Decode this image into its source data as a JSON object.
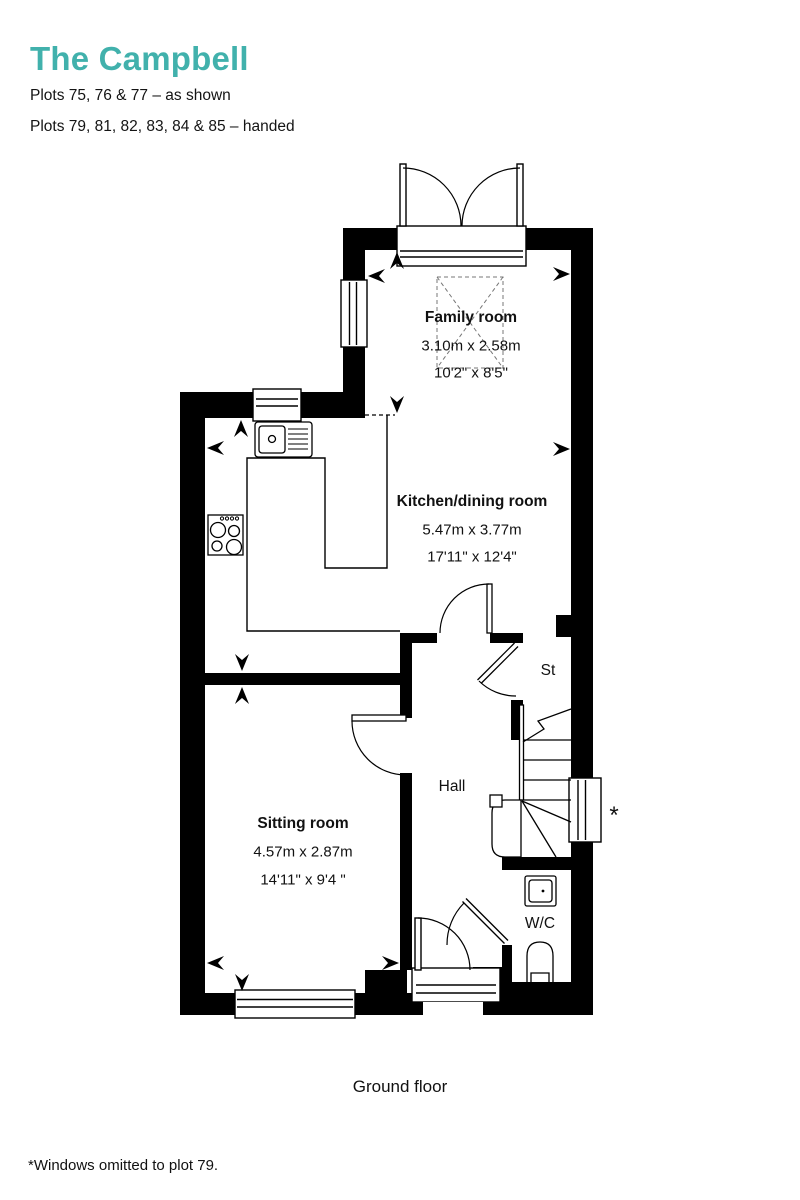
{
  "header": {
    "title": "The Campbell",
    "plots_line1": "Plots 75, 76 & 77 – as shown",
    "plots_line2": "Plots 79, 81, 82, 83, 84 & 85 – handed"
  },
  "colors": {
    "accent_teal": "#41b1ac",
    "wall_black": "#000000"
  },
  "rooms": [
    {
      "id": "family-room",
      "name": "Family room",
      "metric": "3.10m x 2.58m",
      "imperial": "10'2\" x 8'5\""
    },
    {
      "id": "kitchen",
      "name": "Kitchen/dining room",
      "metric": "5.47m x 3.77m",
      "imperial": "17'11\" x 12'4\""
    },
    {
      "id": "sitting-room",
      "name": "Sitting room",
      "metric": "4.57m x 2.87m",
      "imperial": "14'11\" x 9'4 \""
    }
  ],
  "labels": {
    "hall": "Hall",
    "store": "St",
    "wc": "W/C",
    "floor": "Ground floor",
    "window_marker": "*",
    "footnote": "*Windows omitted to plot 79."
  }
}
